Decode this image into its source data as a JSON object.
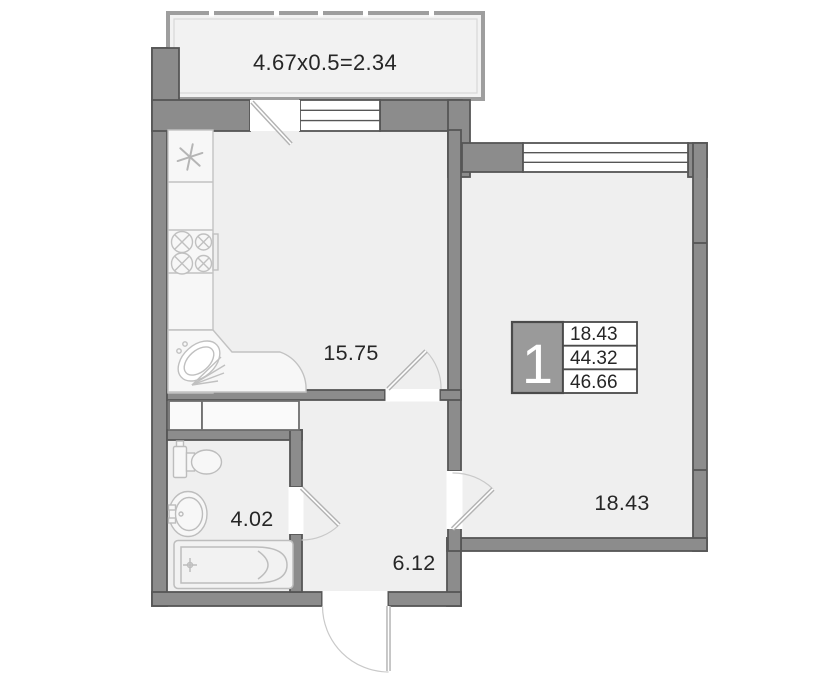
{
  "plan": {
    "balcony": {
      "label": "4.67x0.5=2.34"
    },
    "rooms": {
      "living_kitchen": {
        "area": "15.75"
      },
      "bedroom": {
        "area": "18.43"
      },
      "bathroom": {
        "area": "4.02"
      },
      "hallway": {
        "area": "6.12"
      }
    },
    "info_box": {
      "unit_number": "1",
      "rows": [
        "18.43",
        "44.32",
        "46.66"
      ]
    },
    "fixture_icons": {
      "kitchen": [
        "asterisk-vent-icon",
        "stove-burners-icon",
        "corner-sink-icon"
      ],
      "bathroom": [
        "toilet-icon",
        "washbasin-icon",
        "bathtub-icon"
      ]
    },
    "colors": {
      "wall_fill": "#8c8c8c",
      "wall_outline": "#565656",
      "room_fill": "#efefef",
      "balcony_fill": "#f2f2f2",
      "info_cell_fill": "#9a9a9a",
      "text": "#262626"
    }
  }
}
